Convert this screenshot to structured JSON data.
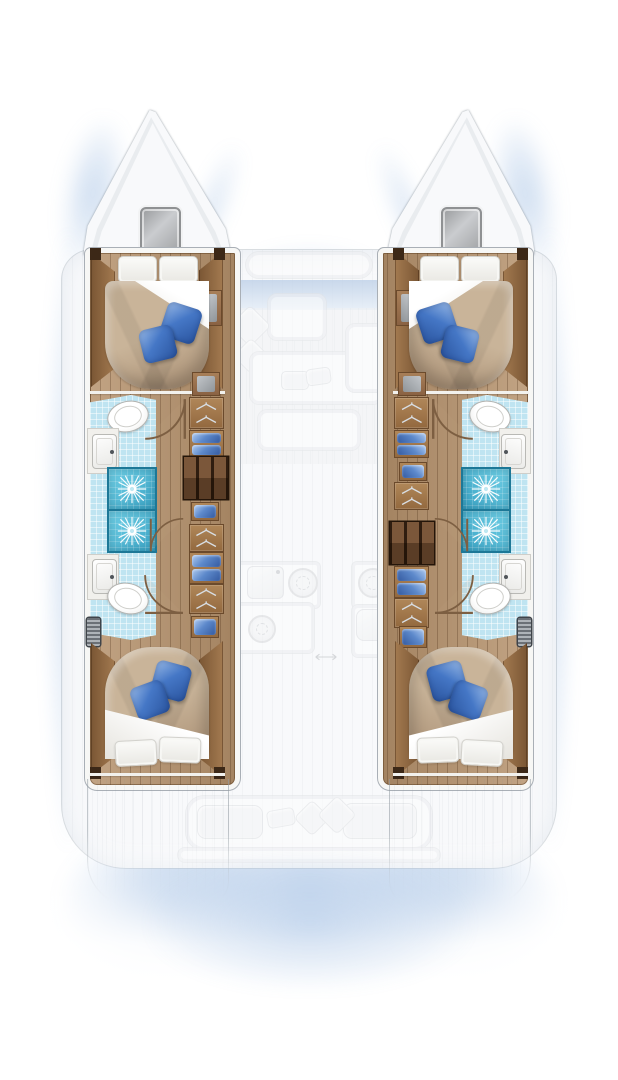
{
  "document": {
    "kind": "boat floor plan illustration",
    "vessel_type": "sailing catamaran (twin hulls)",
    "view": "overhead interior layout",
    "highlighted_level": "hull accommodations rendered in full colour",
    "ghosted_level": "bridgedeck level (foredeck seat, saloon, galley, aft cockpit) shown faded"
  },
  "labels": {
    "boat": "Catamaran layout plan",
    "port_hull": "Port hull",
    "starboard_hull": "Starboard hull",
    "bow": "Bow with deck hatch",
    "forward_cabin": "Forward double cabin",
    "aft_cabin": "Aft double cabin",
    "bathroom": "En-suite head with shower stalls",
    "companionway": "Companionway steps",
    "wardrobe": "Wardrobe with hangers",
    "linen_locker": "Locker with blue linens",
    "saloon": "Saloon seating (ghosted)",
    "galley": "Galley (ghosted)",
    "cockpit": "Aft cockpit bench (ghosted)",
    "foredeck": "Foredeck seat (ghosted)"
  },
  "counts": {
    "hulls": 2,
    "double_cabins": 4,
    "heads": 4,
    "shower_stalls": 4,
    "toilets": 4,
    "sinks": 4,
    "deck_hatches": 2,
    "companionway_steps": 2,
    "blue_accent_pillows": 8,
    "white_pillows": 8
  },
  "icons": {
    "shower_drain": "white sunburst on cyan shower pan",
    "wardrobe": "clothes-hanger glyphs on wood locker",
    "door": "quarter-circle swing arc",
    "stove_burner": "ghosted burner circle",
    "vent": "louvered grille"
  },
  "colors": {
    "page_bg": "#ffffff",
    "deck": "#f8f9fb",
    "hull_border": "#a9afb6",
    "hull_wall": "#f7f7f5",
    "wood": "#b6926c",
    "trim": "#8a6343",
    "steps_dark": "#3a2513",
    "duvet": "#c9b499",
    "sheet": "#f6f5f1",
    "pillow_blue": "#4577c6",
    "pillow_blue_dark": "#2a549e",
    "pillow_blue_light": "#93b5e4",
    "tile": "#bfe4f1",
    "tile_border": "#76aec4",
    "shower": "#4fbedd",
    "shower_border": "#1d7897",
    "hatch": "#a6a8aa",
    "windshield_top": "#b9cde6",
    "locker_blue": "#5d89cb",
    "hanger": "#d8dee4",
    "door_arc": "#7d5f42",
    "glow": "#7fa7d9"
  }
}
